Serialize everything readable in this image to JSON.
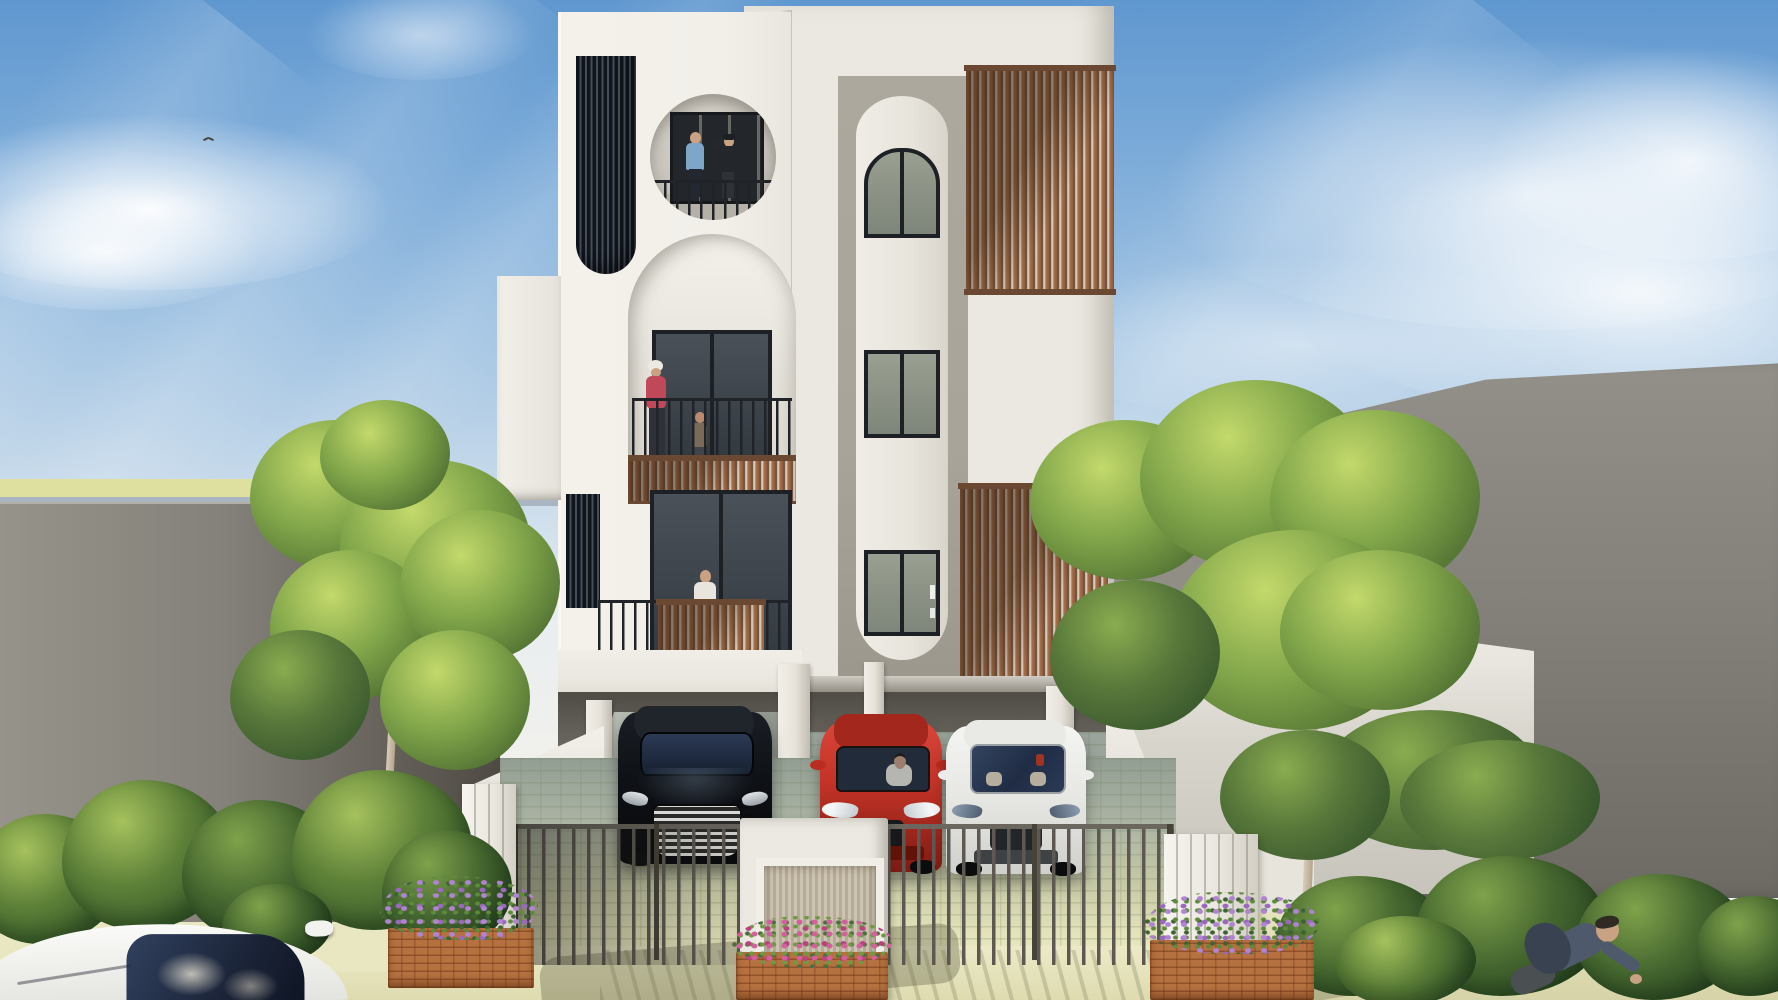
{
  "scene": {
    "title": "3D architectural rendering of a modern three-storey white residential building with ground-floor carport, three parked cars, slatted metal fence, flower planters, trees and neighbouring grey buildings under a blue sky",
    "labels": {
      "sky": "blue sky with diagonal sun rays and soft clouds, small bird flying top-left",
      "building": "white minimalist facade: round balcony opening and tall arched balcony on the left, rounded window pilaster with arched top window in the centre, two brown vertical wood-slat screens on the right, two dark louver panels on the left",
      "balconies": "three balconies with black metal railings and brown wood-slat fronts; residents standing on each level",
      "carport": "open ground-floor carport on white columns with paver floor",
      "cars": "black sedan, red hatchback with driver, white sedan parked side by side; white car roof in foreground bottom-left",
      "fence": "dark vertical-bar fence with white gate posts and a central white gate pillar with wood infill",
      "planters": "three brick planter boxes with pink and purple flowers",
      "landscape": "green hedge along left boundary wall, two leafy trees, bushes along right wall",
      "people_outside": "man with backpack riding along the street bottom-right",
      "neighbours": "large grey boundary walls left and right, tall grey building far right, low white house on the right"
    },
    "objects": {
      "building": {
        "floors": 3,
        "balcony_people": [
          "man in blue shirt",
          "man in black with cap",
          "white-haired woman in red",
          "child in plaid",
          "man in white shirt",
          "small child in pink"
        ]
      },
      "cars": [
        {
          "color": "black",
          "position": "left carport bay"
        },
        {
          "color": "red",
          "position": "centre carport bay",
          "driver": "person in white shirt"
        },
        {
          "color": "white",
          "position": "right carport bay"
        },
        {
          "color": "white",
          "position": "foreground street, partially visible"
        }
      ],
      "planters": [
        {
          "flowers": "purple",
          "position": "left of gate"
        },
        {
          "flowers": "pink",
          "position": "centre gate pillar"
        },
        {
          "flowers": "purple",
          "position": "right of gate"
        }
      ],
      "trees": 2,
      "bird": 1
    }
  },
  "palette": {
    "skyTop": "#5f97cf",
    "sky2": "#79a9d8",
    "sky3": "#9fc2e2",
    "sky4": "#c6d9ea",
    "skyHorizon": "#edf0ef",
    "horizonYellow": "#dde09e",
    "horizonBlue": "#a9b6c2",
    "leftWallLight": "#96938a",
    "leftWallDark": "#4e4a43",
    "grass": "#9cb064",
    "midWall": "#908d85",
    "tallWallTop": "#93908a",
    "tallWallBottom": "#6d6a64",
    "whiteBldgFace": "#d8d5cd",
    "bldgWhite": "#f2efe9",
    "backWhite": "#ebe8e1",
    "panelGray": "#a8a49a",
    "wood1": "#a8714c",
    "wood2": "#5d3f2a",
    "woodGapLight": "#d8cfc0",
    "woodCap": "#6b4832",
    "louvDark": "#10141b",
    "louvGap": "#454d58",
    "frame": "#1d2024",
    "rail": "#202327",
    "soffit": "#57544e",
    "paverLine": "rgba(110,130,95,.30)",
    "fenceBar": "#5d5952",
    "brick": "#b5713f",
    "brickLine": "rgba(110,50,20,.5)",
    "flowerPink": "#d45f9f",
    "flowerPink2": "#b8437f",
    "flowerPurple": "#b184d2",
    "flowerPurple2": "#9a68bf",
    "bushLight": "#a6c25d",
    "bushMid": "#5d8038",
    "bushDark": "#2e4e27",
    "treeLight": "#c3d96b",
    "treeMid": "#7fa449",
    "treeDark": "#49682f",
    "carBlack": "#0d1013",
    "carRed": "#c43327",
    "carWhite": "#ededeb",
    "skin": "#c9a183",
    "shirtBlue": "#7ea6c8",
    "shirtRed": "#c04858",
    "jacket": "#4e5a6b",
    "backpack": "#394250"
  }
}
